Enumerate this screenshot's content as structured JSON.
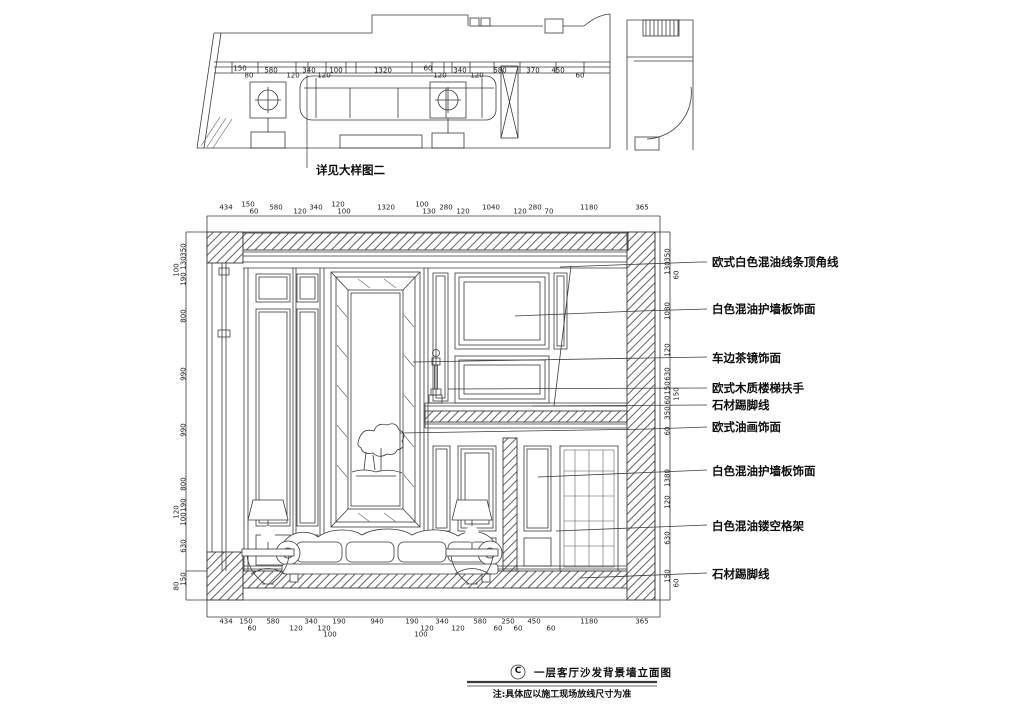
{
  "plan": {
    "detail_label": "详见大样图二"
  },
  "annotations": [
    "欧式白色混油线条顶角线",
    "白色混油护墙板饰面",
    "车边茶镜饰面",
    "欧式木质楼梯扶手",
    "石材踢脚线",
    "欧式油画饰面",
    "白色混油护墙板饰面",
    "白色混油镂空格架",
    "石材踢脚线"
  ],
  "titleblock": {
    "ref": "C",
    "title": "一层客厅沙发背景墙立面图",
    "note": "注:具体应以施工现场放线尺寸为准"
  },
  "dims": {
    "plan": [
      {
        "t": "150",
        "x": 240,
        "y": 69
      },
      {
        "t": "80",
        "x": 249,
        "y": 76
      },
      {
        "t": "580",
        "x": 271,
        "y": 71
      },
      {
        "t": "120",
        "x": 293,
        "y": 76
      },
      {
        "t": "340",
        "x": 309,
        "y": 71
      },
      {
        "t": "120",
        "x": 324,
        "y": 76
      },
      {
        "t": "100",
        "x": 336,
        "y": 71
      },
      {
        "t": "1320",
        "x": 383,
        "y": 71
      },
      {
        "t": "60",
        "x": 428,
        "y": 69
      },
      {
        "t": "120",
        "x": 440,
        "y": 76
      },
      {
        "t": "340",
        "x": 460,
        "y": 71
      },
      {
        "t": "120",
        "x": 477,
        "y": 76
      },
      {
        "t": "580",
        "x": 500,
        "y": 71
      },
      {
        "t": "370",
        "x": 533,
        "y": 71
      },
      {
        "t": "450",
        "x": 558,
        "y": 71
      },
      {
        "t": "60",
        "x": 580,
        "y": 76
      }
    ],
    "top": [
      {
        "t": "434",
        "x": 226,
        "y": 208
      },
      {
        "t": "150",
        "x": 248,
        "y": 205
      },
      {
        "t": "60",
        "x": 254,
        "y": 212
      },
      {
        "t": "580",
        "x": 276,
        "y": 208
      },
      {
        "t": "120",
        "x": 300,
        "y": 212
      },
      {
        "t": "340",
        "x": 316,
        "y": 208
      },
      {
        "t": "120",
        "x": 338,
        "y": 205
      },
      {
        "t": "100",
        "x": 344,
        "y": 212
      },
      {
        "t": "1320",
        "x": 386,
        "y": 208
      },
      {
        "t": "100",
        "x": 422,
        "y": 205
      },
      {
        "t": "130",
        "x": 429,
        "y": 212
      },
      {
        "t": "280",
        "x": 446,
        "y": 208
      },
      {
        "t": "120",
        "x": 463,
        "y": 212
      },
      {
        "t": "1040",
        "x": 491,
        "y": 208
      },
      {
        "t": "120",
        "x": 520,
        "y": 212
      },
      {
        "t": "280",
        "x": 535,
        "y": 208
      },
      {
        "t": "70",
        "x": 549,
        "y": 212
      },
      {
        "t": "1180",
        "x": 589,
        "y": 208
      },
      {
        "t": "365",
        "x": 642,
        "y": 208
      }
    ],
    "bottom": [
      {
        "t": "434",
        "x": 226,
        "y": 622
      },
      {
        "t": "150",
        "x": 246,
        "y": 622
      },
      {
        "t": "60",
        "x": 252,
        "y": 629
      },
      {
        "t": "580",
        "x": 273,
        "y": 622
      },
      {
        "t": "120",
        "x": 296,
        "y": 629
      },
      {
        "t": "340",
        "x": 311,
        "y": 622
      },
      {
        "t": "120",
        "x": 324,
        "y": 629
      },
      {
        "t": "100",
        "x": 330,
        "y": 635
      },
      {
        "t": "190",
        "x": 339,
        "y": 622
      },
      {
        "t": "940",
        "x": 377,
        "y": 622
      },
      {
        "t": "190",
        "x": 412,
        "y": 622
      },
      {
        "t": "100",
        "x": 421,
        "y": 635
      },
      {
        "t": "120",
        "x": 427,
        "y": 629
      },
      {
        "t": "340",
        "x": 442,
        "y": 622
      },
      {
        "t": "120",
        "x": 458,
        "y": 629
      },
      {
        "t": "580",
        "x": 480,
        "y": 622
      },
      {
        "t": "60",
        "x": 498,
        "y": 629
      },
      {
        "t": "250",
        "x": 508,
        "y": 622
      },
      {
        "t": "60",
        "x": 518,
        "y": 629
      },
      {
        "t": "450",
        "x": 534,
        "y": 622
      },
      {
        "t": "60",
        "x": 551,
        "y": 629
      },
      {
        "t": "1180",
        "x": 589,
        "y": 622
      },
      {
        "t": "365",
        "x": 642,
        "y": 622
      }
    ],
    "left": [
      {
        "t": "350",
        "x": 184,
        "y": 250
      },
      {
        "t": "130",
        "x": 184,
        "y": 263
      },
      {
        "t": "100",
        "x": 177,
        "y": 270
      },
      {
        "t": "190",
        "x": 184,
        "y": 279
      },
      {
        "t": "800",
        "x": 184,
        "y": 316
      },
      {
        "t": "990",
        "x": 184,
        "y": 374
      },
      {
        "t": "990",
        "x": 184,
        "y": 430
      },
      {
        "t": "800",
        "x": 184,
        "y": 484
      },
      {
        "t": "190",
        "x": 184,
        "y": 505
      },
      {
        "t": "120",
        "x": 177,
        "y": 512
      },
      {
        "t": "100",
        "x": 184,
        "y": 519
      },
      {
        "t": "630",
        "x": 184,
        "y": 546
      },
      {
        "t": "150",
        "x": 184,
        "y": 579
      },
      {
        "t": "80",
        "x": 177,
        "y": 586
      }
    ],
    "right": [
      {
        "t": "350",
        "x": 668,
        "y": 255
      },
      {
        "t": "130",
        "x": 668,
        "y": 268
      },
      {
        "t": "60",
        "x": 677,
        "y": 275
      },
      {
        "t": "1080",
        "x": 668,
        "y": 311
      },
      {
        "t": "120",
        "x": 668,
        "y": 350
      },
      {
        "t": "630",
        "x": 668,
        "y": 374
      },
      {
        "t": "150",
        "x": 668,
        "y": 388
      },
      {
        "t": "150",
        "x": 677,
        "y": 394
      },
      {
        "t": "60",
        "x": 668,
        "y": 400
      },
      {
        "t": "350",
        "x": 668,
        "y": 413
      },
      {
        "t": "60",
        "x": 668,
        "y": 431
      },
      {
        "t": "1380",
        "x": 668,
        "y": 478
      },
      {
        "t": "120",
        "x": 668,
        "y": 502
      },
      {
        "t": "630",
        "x": 668,
        "y": 538
      },
      {
        "t": "150",
        "x": 668,
        "y": 576
      },
      {
        "t": "60",
        "x": 677,
        "y": 583
      }
    ]
  },
  "colors": {
    "line": "#3a3a3a",
    "hatch": "#6a6a6a",
    "text": "#111111"
  }
}
